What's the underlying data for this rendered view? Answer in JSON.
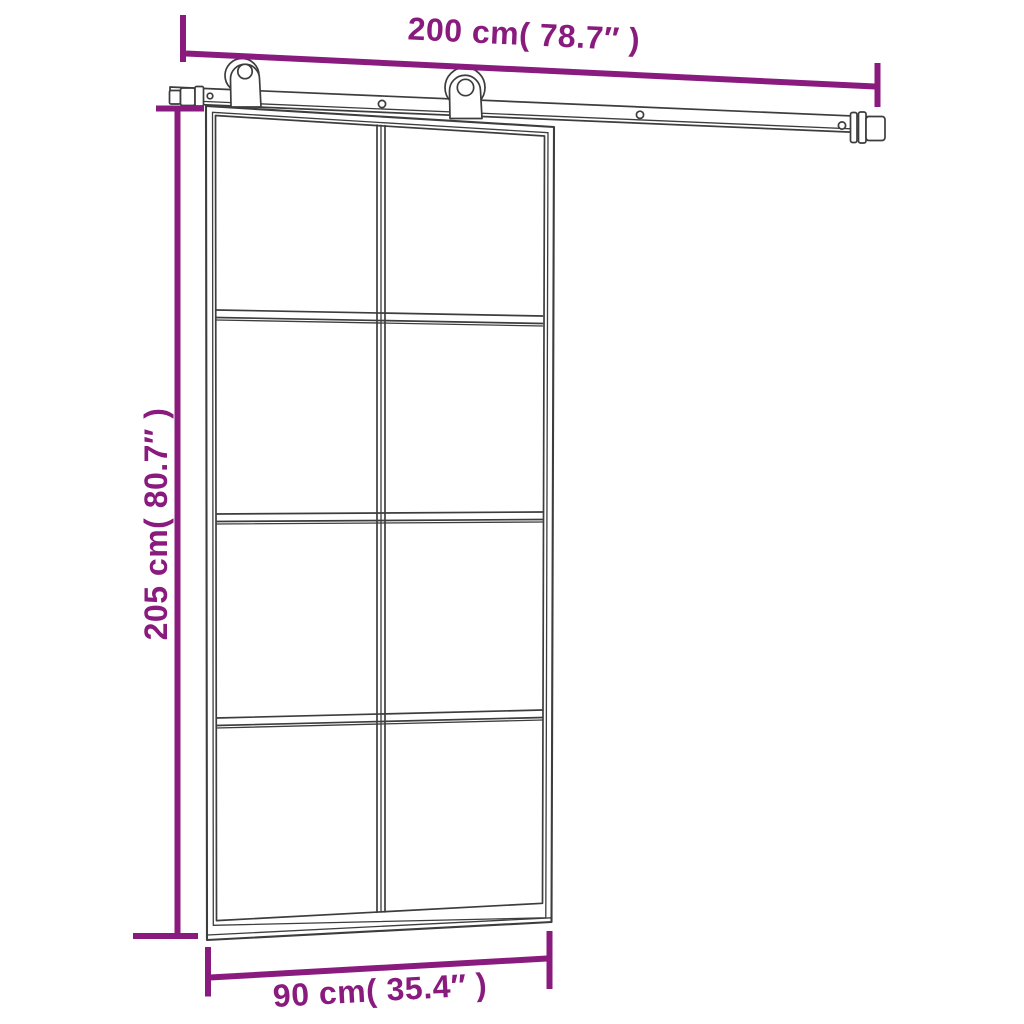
{
  "diagram": {
    "colors": {
      "dimension": "#8a1b7e",
      "line": "#3d3d3d",
      "background": "#ffffff"
    },
    "labels": {
      "rail_width": "200 cm( 78.7″ )",
      "door_height": "205 cm( 80.7″ )",
      "door_width": "90 cm( 35.4″ )"
    },
    "structure": {
      "glass_rows": 4,
      "glass_columns": 2,
      "rollers": 2
    }
  }
}
